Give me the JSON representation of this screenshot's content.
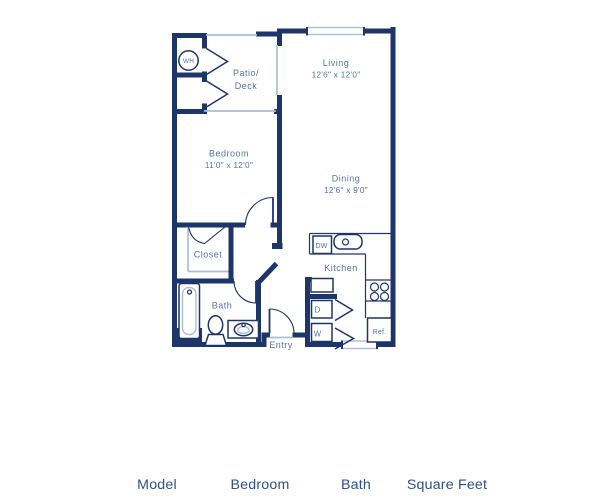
{
  "colors": {
    "wall": "#1d3569",
    "label": "#5474a6",
    "light": "#aebed8",
    "header": "#2f4f8f"
  },
  "floorplan": {
    "rooms": {
      "patio": {
        "line1": "Patio/",
        "line2": "Deck"
      },
      "living": {
        "name": "Living",
        "dims": "12'6\" x 12'0\""
      },
      "bedroom": {
        "name": "Bedroom",
        "dims": "11'0\" x 12'0\""
      },
      "dining": {
        "name": "Dining",
        "dims": "12'6\" x 9'0\""
      },
      "closet": {
        "name": "Closet"
      },
      "bath": {
        "name": "Bath"
      },
      "kitchen": {
        "name": "Kitchen"
      },
      "entry": {
        "name": "Entry"
      }
    },
    "appliances": {
      "water_heater": "WH",
      "dishwasher": "DW",
      "dryer": "D",
      "washer": "W",
      "refrigerator": "Ref."
    }
  },
  "table": {
    "headers": [
      "Model",
      "Bedroom",
      "Bath",
      "Square Feet"
    ]
  }
}
